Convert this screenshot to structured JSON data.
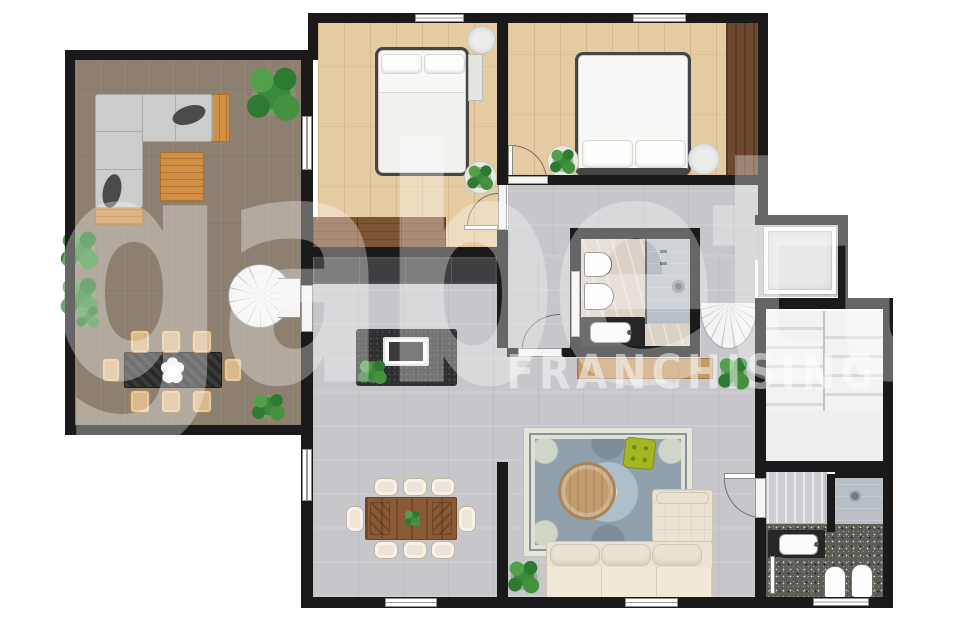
{
  "watermark": {
    "brand": "gabetti",
    "subtitle": "FRANCHISING",
    "color": "#ffffff"
  },
  "palette": {
    "wall": "#1a1a1a",
    "veranda_floor": "#8d8070",
    "bedroom_floor": "#e5cba2",
    "wood_dark": "#6f4a31",
    "wood_mid": "#7d5434",
    "accent_wood": "#d28f44",
    "tile_floor": "#c7c7cb",
    "marble": "#dbd2c6",
    "shower": "#b7bec4",
    "terrazzo": "#5a5e56",
    "stair": "#efefef",
    "sofa_gray": "#cccccb",
    "cream": "#eae3d3",
    "rug_field": "#8fa0ac",
    "rug_border": "#e9e5d6",
    "rug_light": "#aebfca",
    "round_table": "#c29b6e",
    "ottoman_green": "#a2b524",
    "island_dark": "#2d2e2e",
    "closet_dark": "#3e3f41",
    "plant_dark": "#2e7a33",
    "plant_light": "#53a04a"
  },
  "rooms": [
    "veranda-living-room",
    "bedroom-1",
    "bedroom-2",
    "hallway",
    "kitchen-dining-living",
    "bathroom-main",
    "elevator-closet-room",
    "staircase",
    "vestibule",
    "bathroom-second"
  ]
}
